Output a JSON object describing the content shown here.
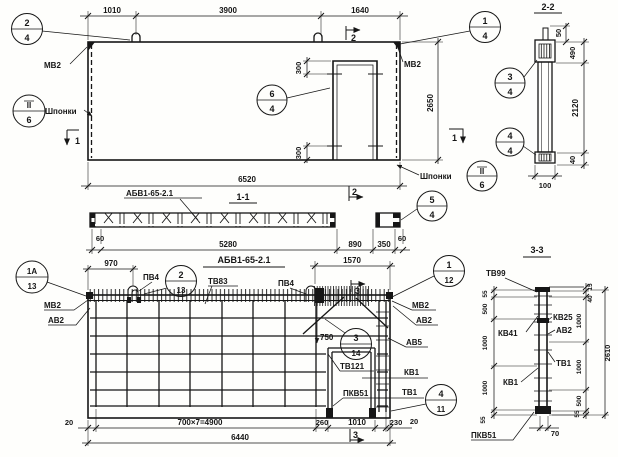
{
  "colors": {
    "ink": "#161616",
    "paper": "#fefefc"
  },
  "plan": {
    "dims_top": [
      "1010",
      "3900",
      "1640"
    ],
    "dim_height": "2650",
    "dim_width": "6520",
    "opening_dim_top": "300",
    "opening_dim_bottom": "300",
    "label_mv2_left": "МВ2",
    "label_mv2_right": "МВ2",
    "label_shponki_left": "Шпонки",
    "label_shponki_right": "Шпонки",
    "c24": {
      "a": "2",
      "b": "4"
    },
    "c14": {
      "a": "1",
      "b": "4"
    },
    "c64": {
      "a": "6",
      "b": "4"
    },
    "ckey_left": {
      "a": "II",
      "b": "6"
    },
    "ckey_right": {
      "a": "II",
      "b": "6"
    },
    "cut1_left": "1",
    "cut2_top": "2",
    "cut1_right": "1"
  },
  "section11": {
    "title": "1-1",
    "part_label": "АБВ1-65-2.1",
    "dims": [
      "60",
      "5280",
      "890",
      "350",
      "60"
    ],
    "c54": {
      "a": "5",
      "b": "4"
    },
    "cut2_bottom": "2"
  },
  "section22": {
    "title": "2-2",
    "dim_50": "50",
    "dim_490": "490",
    "dim_2120": "2120",
    "dim_40": "40",
    "dim_100": "100",
    "c34": {
      "a": "3",
      "b": "4"
    },
    "c44": {
      "a": "4",
      "b": "4"
    }
  },
  "reinf": {
    "title": "АБВ1-65-2.1",
    "dim_970": "970",
    "dim_1570": "1570",
    "dim_750": "750",
    "label_mv2_left": "МВ2",
    "label_av2_left": "АВ2",
    "label_pv4_1": "ПВ4",
    "label_tv83": "ТВ83",
    "label_pv4_2": "ПВ4",
    "label_mv2_right": "МВ2",
    "label_av2_right": "АВ2",
    "label_av5": "АВ5",
    "label_kv1": "КВ1",
    "label_tv1": "ТВ1",
    "label_tv121": "ТВ121",
    "label_pkv51": "ПКВ51",
    "c1a13": {
      "a": "1А",
      "b": "13"
    },
    "c213": {
      "a": "2",
      "b": "13"
    },
    "c112": {
      "a": "1",
      "b": "12"
    },
    "c314": {
      "a": "3",
      "b": "14"
    },
    "c411": {
      "a": "4",
      "b": "11"
    },
    "cut3_top": "3",
    "cut3_bottom": "3",
    "dims_bottom": [
      "20",
      "700×7=4900",
      "260",
      "1010",
      "230",
      "20"
    ],
    "dim_total": "6440"
  },
  "section33": {
    "title": "3-3",
    "label_tv99": "ТВ99",
    "label_kv25": "КВ25",
    "label_av2": "АВ2",
    "label_kv41": "КВ41",
    "label_tv1": "ТВ1",
    "label_kv1": "КВ1",
    "label_pkv51": "ПКВ51",
    "dims_left": [
      "55",
      "500",
      "1000",
      "1000",
      "55"
    ],
    "dims_right": [
      "15",
      "40",
      "1000",
      "1000",
      "500",
      "55"
    ],
    "dim_total": "2610",
    "dim_70": "70"
  }
}
